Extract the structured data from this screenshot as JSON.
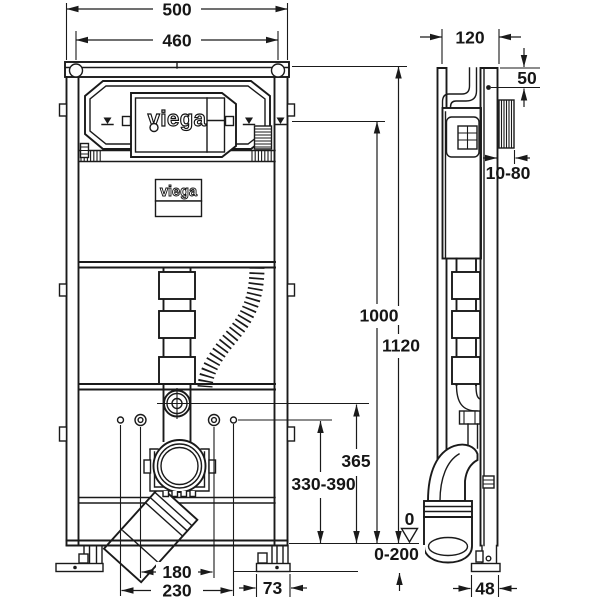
{
  "drawing": {
    "title": "WC element installation drawing",
    "brand": {
      "logo_main": "viega",
      "logo_plate": "viega"
    },
    "dims": {
      "outer_width": "500",
      "hole_spacing": "460",
      "depth": "120",
      "top_fixing": "50",
      "wall_clearance": "10-80",
      "actuation_height": "1000",
      "total_height": "1120",
      "supply_height": "365",
      "outlet_height": "330-390",
      "datum": "0",
      "foot_adjust": "0-200",
      "span_inner": "180",
      "span_outer": "230",
      "foot_width": "73",
      "foot_depth": "48"
    }
  }
}
